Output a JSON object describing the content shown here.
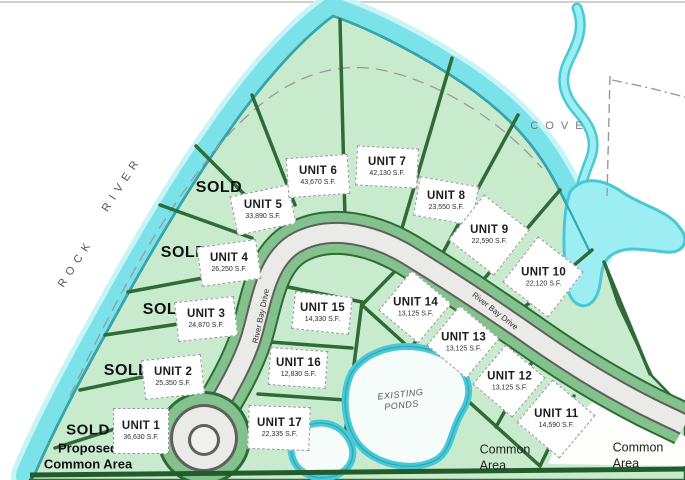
{
  "title": "River Bay Drive Subdivision Plat",
  "labels": {
    "rock": "ROCK",
    "river": "RIVER",
    "cove": "COVE",
    "road": "River Bay Drive",
    "existing_ponds": [
      "EXISTING",
      "PONDS"
    ],
    "common_area": [
      "Common",
      "Area"
    ],
    "proposed": [
      "SOLD",
      "Proposed",
      "Common Area"
    ]
  },
  "sold_labels": [
    "SOLD",
    "SOLD",
    "SOLD",
    "SOLD"
  ],
  "units": [
    {
      "name": "UNIT 1",
      "sf": "36,630 S.F."
    },
    {
      "name": "UNIT 2",
      "sf": "25,350 S.F."
    },
    {
      "name": "UNIT 3",
      "sf": "24,870 S.F."
    },
    {
      "name": "UNIT 4",
      "sf": "26,250 S.F."
    },
    {
      "name": "UNIT 5",
      "sf": "33,890 S.F."
    },
    {
      "name": "UNIT 6",
      "sf": "43,670 S.F."
    },
    {
      "name": "UNIT 7",
      "sf": "42,130 S.F."
    },
    {
      "name": "UNIT 8",
      "sf": "23,550 S.F."
    },
    {
      "name": "UNIT 9",
      "sf": "22,590 S.F."
    },
    {
      "name": "UNIT 10",
      "sf": "22,120 S.F."
    },
    {
      "name": "UNIT 11",
      "sf": "14,590 S.F."
    },
    {
      "name": "UNIT 12",
      "sf": "13,125 S.F."
    },
    {
      "name": "UNIT 13",
      "sf": "13,125 S.F."
    },
    {
      "name": "UNIT 14",
      "sf": "13,125 S.F."
    },
    {
      "name": "UNIT 15",
      "sf": "14,330 S.F."
    },
    {
      "name": "UNIT 16",
      "sf": "12,830 S.F."
    },
    {
      "name": "UNIT 17",
      "sf": "22,335 S.F."
    }
  ],
  "colors": {
    "land": "#c8ebcd",
    "lot_line": "#2f6b36",
    "river_water": "#7ce2ea",
    "water_edge": "#2fa8ba",
    "road_pavement": "#eaeae7",
    "road_edge": "#5f5f5f",
    "road_berm": "#83c28c"
  }
}
